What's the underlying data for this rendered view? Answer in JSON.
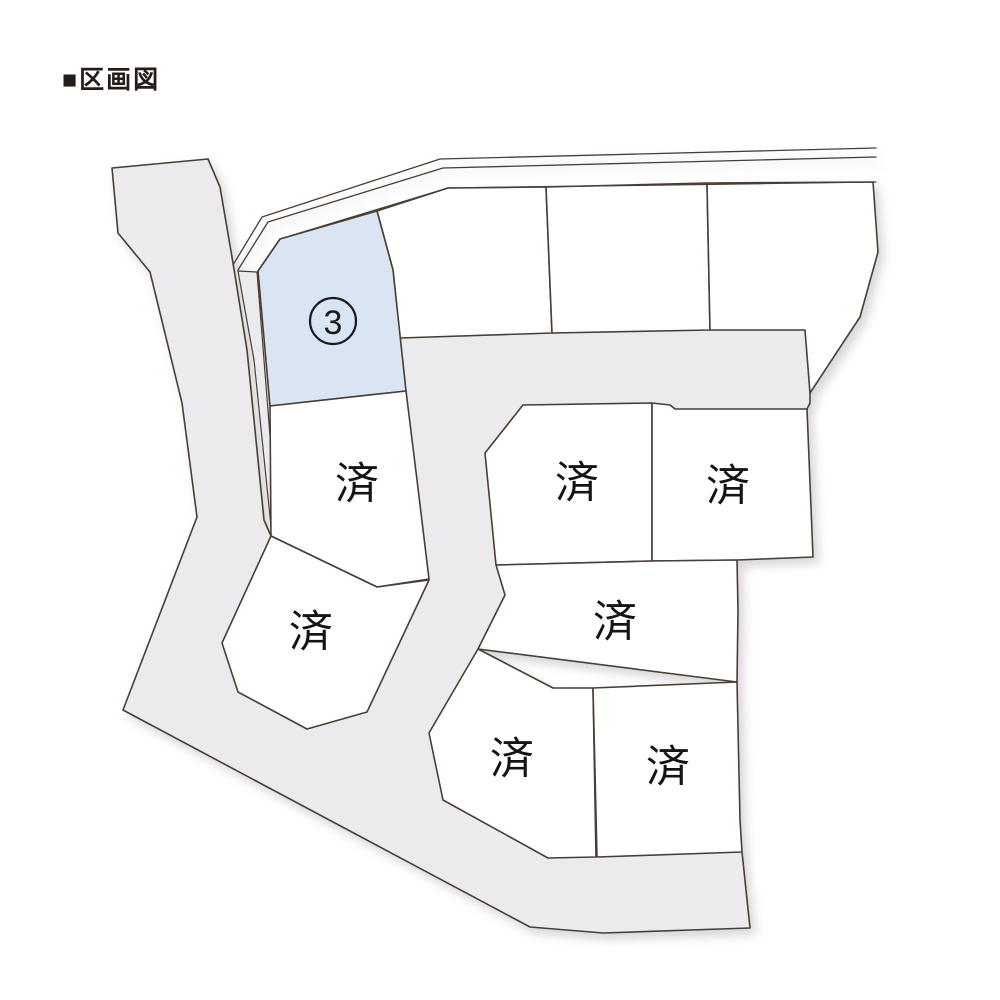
{
  "header": {
    "title": "■区画図"
  },
  "map": {
    "colors": {
      "road": "#ebebed",
      "highlight": "#d9e5f3",
      "stroke": "#4a3d35",
      "plot_fill": "#ffffff",
      "label": "#141414"
    },
    "available_plot": {
      "number": "3",
      "status": "available"
    },
    "sold_plots": [
      {
        "label": "済"
      },
      {
        "label": "済"
      },
      {
        "label": "済"
      },
      {
        "label": "済"
      },
      {
        "label": "済"
      },
      {
        "label": "済"
      },
      {
        "label": "済"
      }
    ]
  }
}
